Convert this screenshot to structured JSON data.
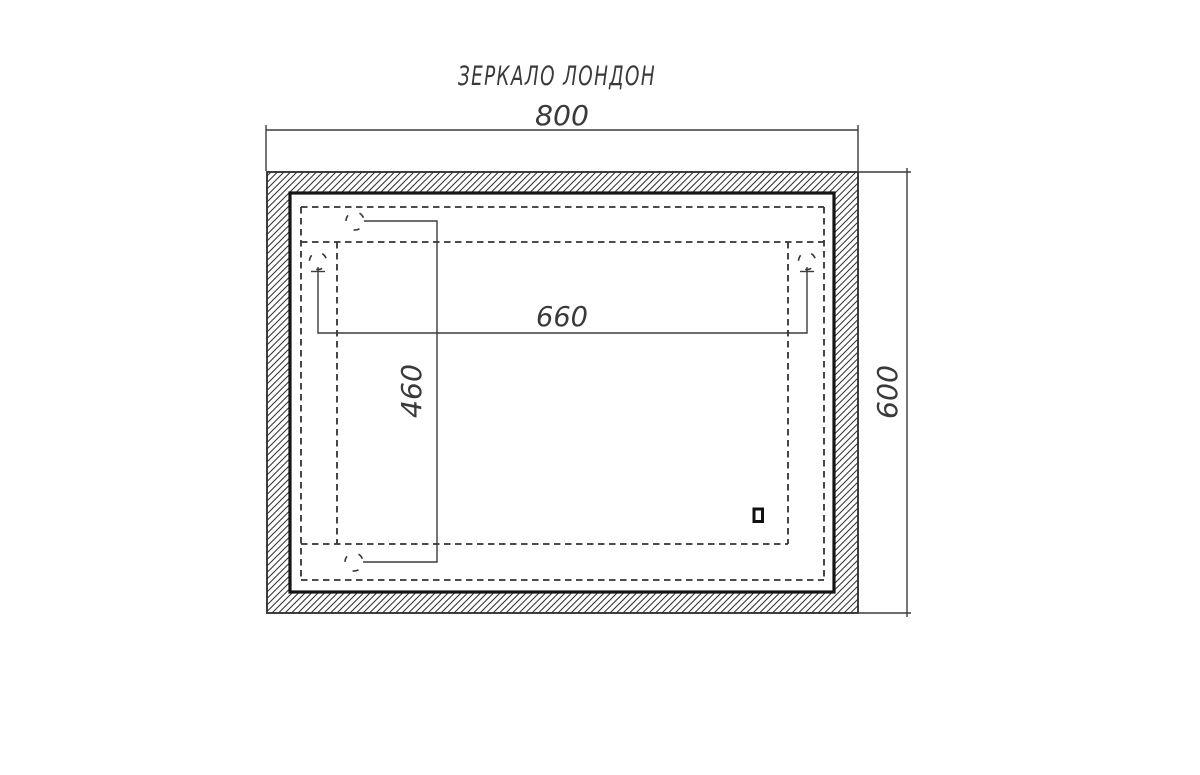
{
  "drawing": {
    "title": "ЗЕРКАЛО  ЛОНДОН",
    "dimensions": {
      "overall_width_mm": "800",
      "overall_height_mm": "600",
      "backlight_width_mm": "660",
      "backlight_height_mm": "460"
    },
    "line_color": "#3a3a3a",
    "background_color": "#ffffff"
  }
}
